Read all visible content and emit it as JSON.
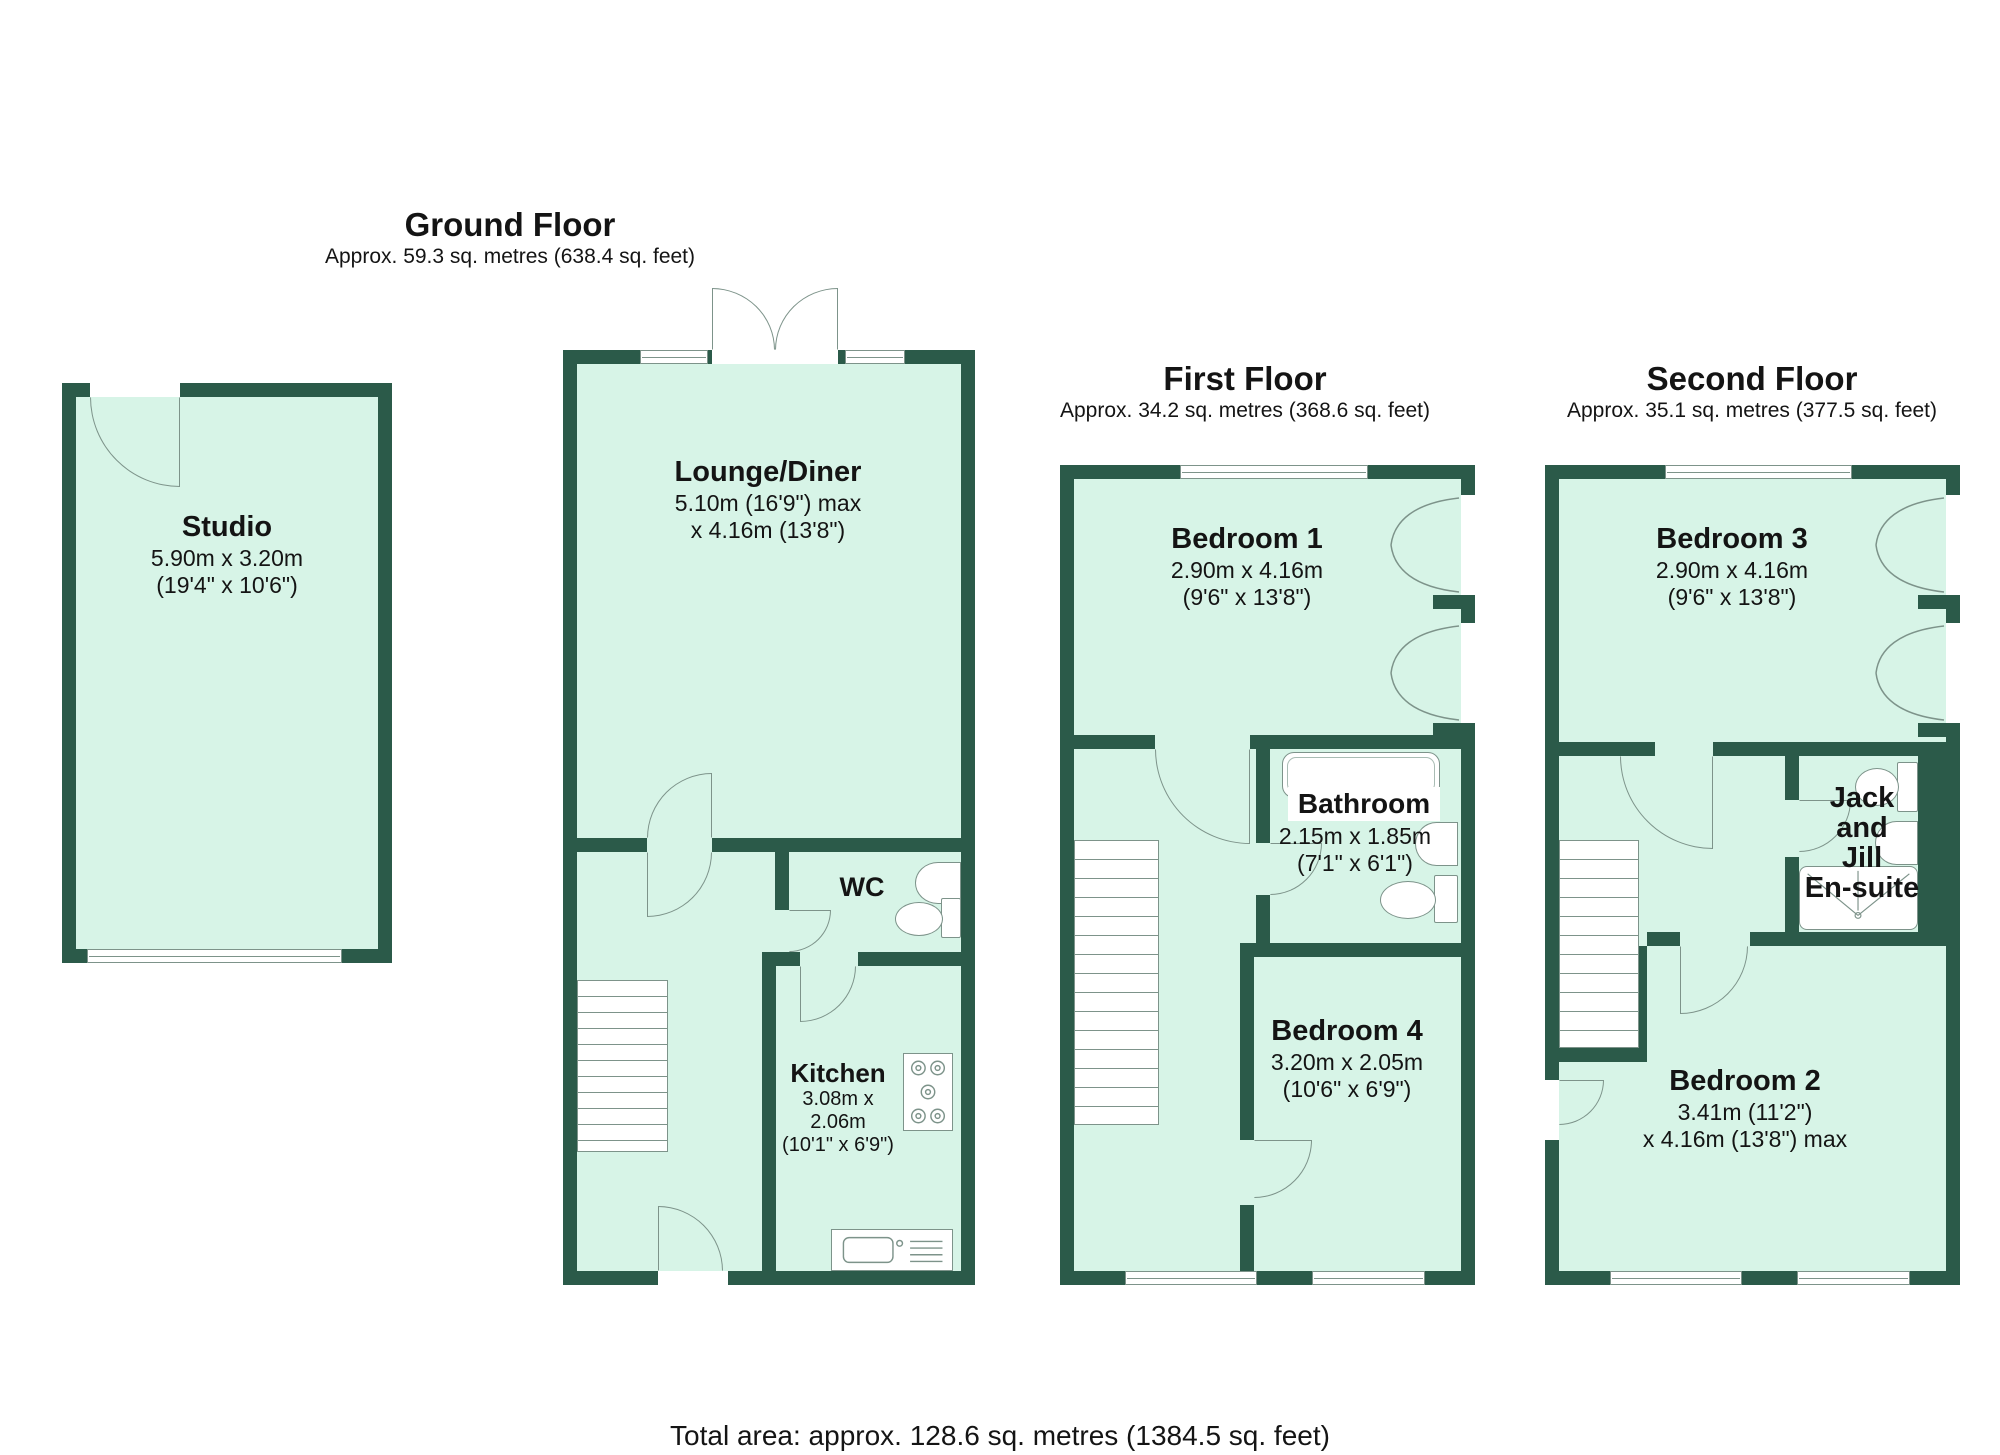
{
  "colors": {
    "wall": "#2b5a49",
    "floor": "#d7f4e7",
    "ln": "#7d938a",
    "txt": "#141414"
  },
  "header": {
    "ground": {
      "title": "Ground Floor",
      "subtitle": "Approx. 59.3 sq. metres (638.4 sq. feet)"
    },
    "first": {
      "title": "First Floor",
      "subtitle": "Approx. 34.2 sq. metres (368.6 sq. feet)"
    },
    "second": {
      "title": "Second Floor",
      "subtitle": "Approx. 35.1 sq. metres (377.5 sq. feet)"
    }
  },
  "rooms": {
    "studio": {
      "name": "Studio",
      "dim_metric": "5.90m x 3.20m",
      "dim_imperial": "(19'4\" x 10'6\")"
    },
    "lounge_diner": {
      "name": "Lounge/Diner",
      "dim_metric": "5.10m (16'9\") max",
      "dim_imperial": "x 4.16m (13'8\")"
    },
    "wc": {
      "name": "WC"
    },
    "kitchen": {
      "name": "Kitchen",
      "dim_metric": "3.08m x 2.06m",
      "dim_imperial": "(10'1\" x 6'9\")"
    },
    "bedroom1": {
      "name": "Bedroom 1",
      "dim_metric": "2.90m x 4.16m",
      "dim_imperial": "(9'6\" x 13'8\")"
    },
    "bathroom": {
      "name": "Bathroom",
      "dim_metric": "2.15m x 1.85m",
      "dim_imperial": "(7'1\" x 6'1\")"
    },
    "bedroom4": {
      "name": "Bedroom 4",
      "dim_metric": "3.20m x 2.05m",
      "dim_imperial": "(10'6\" x 6'9\")"
    },
    "bedroom3": {
      "name": "Bedroom 3",
      "dim_metric": "2.90m x 4.16m",
      "dim_imperial": "(9'6\" x 13'8\")"
    },
    "jack_jill_ensuite": {
      "lines": [
        "Jack",
        "and",
        "Jill",
        "En-suite"
      ]
    },
    "bedroom2": {
      "name": "Bedroom 2",
      "dim_metric": "3.41m (11'2\")",
      "dim_imperial": "x 4.16m (13'8\") max"
    }
  },
  "footer": {
    "total_area": "Total area: approx. 128.6 sq. metres (1384.5 sq. feet)"
  }
}
